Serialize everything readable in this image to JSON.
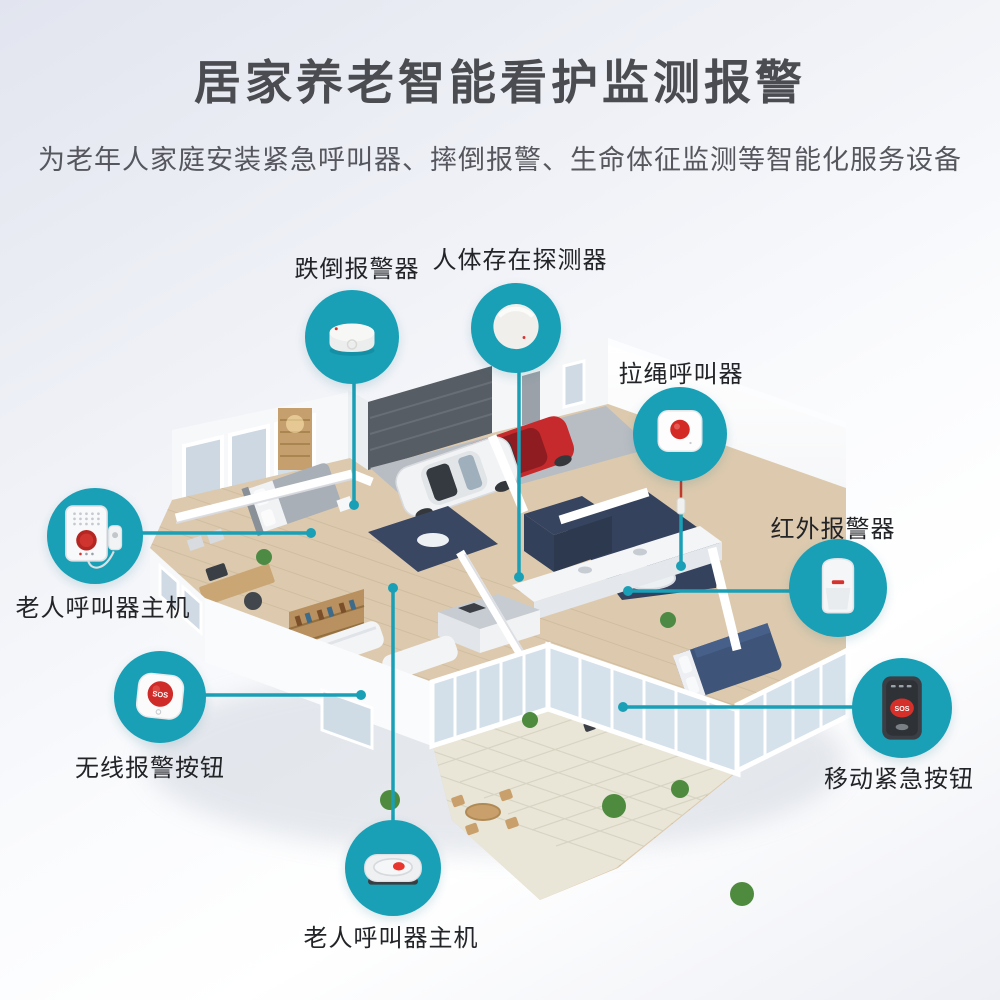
{
  "header": {
    "title": "居家养老智能看护监测报警",
    "subtitle": "为老年人家庭安装紧急呼叫器、摔倒报警、生命体征监测等智能化服务设备"
  },
  "colors": {
    "accent": "#19a0b6",
    "alarm_red": "#d5342e",
    "title_text": "#4b4c51",
    "subtitle_text": "#56575e",
    "label_text": "#232428"
  },
  "callouts": {
    "fall_alarm": {
      "label": "跌倒报警器",
      "icon": "fall-alarm-puck-icon"
    },
    "presence_detector": {
      "label": "人体存在探测器",
      "icon": "presence-sensor-disc-icon"
    },
    "pull_cord_caller": {
      "label": "拉绳呼叫器",
      "icon": "pull-cord-button-icon"
    },
    "infrared_alarm": {
      "label": "红外报警器",
      "icon": "pir-motion-sensor-icon"
    },
    "mobile_sos_button": {
      "label": "移动紧急按钮",
      "icon": "mobile-sos-device-icon",
      "sos_text": "SOS"
    },
    "wall_caller_host": {
      "label": "老人呼叫器主机",
      "icon": "wall-host-device-icon"
    },
    "wireless_sos_button": {
      "label": "无线报警按钮",
      "icon": "wireless-sos-button-icon",
      "sos_text": "SOS"
    },
    "desk_caller_host": {
      "label": "老人呼叫器主机",
      "icon": "desk-host-device-icon"
    }
  }
}
